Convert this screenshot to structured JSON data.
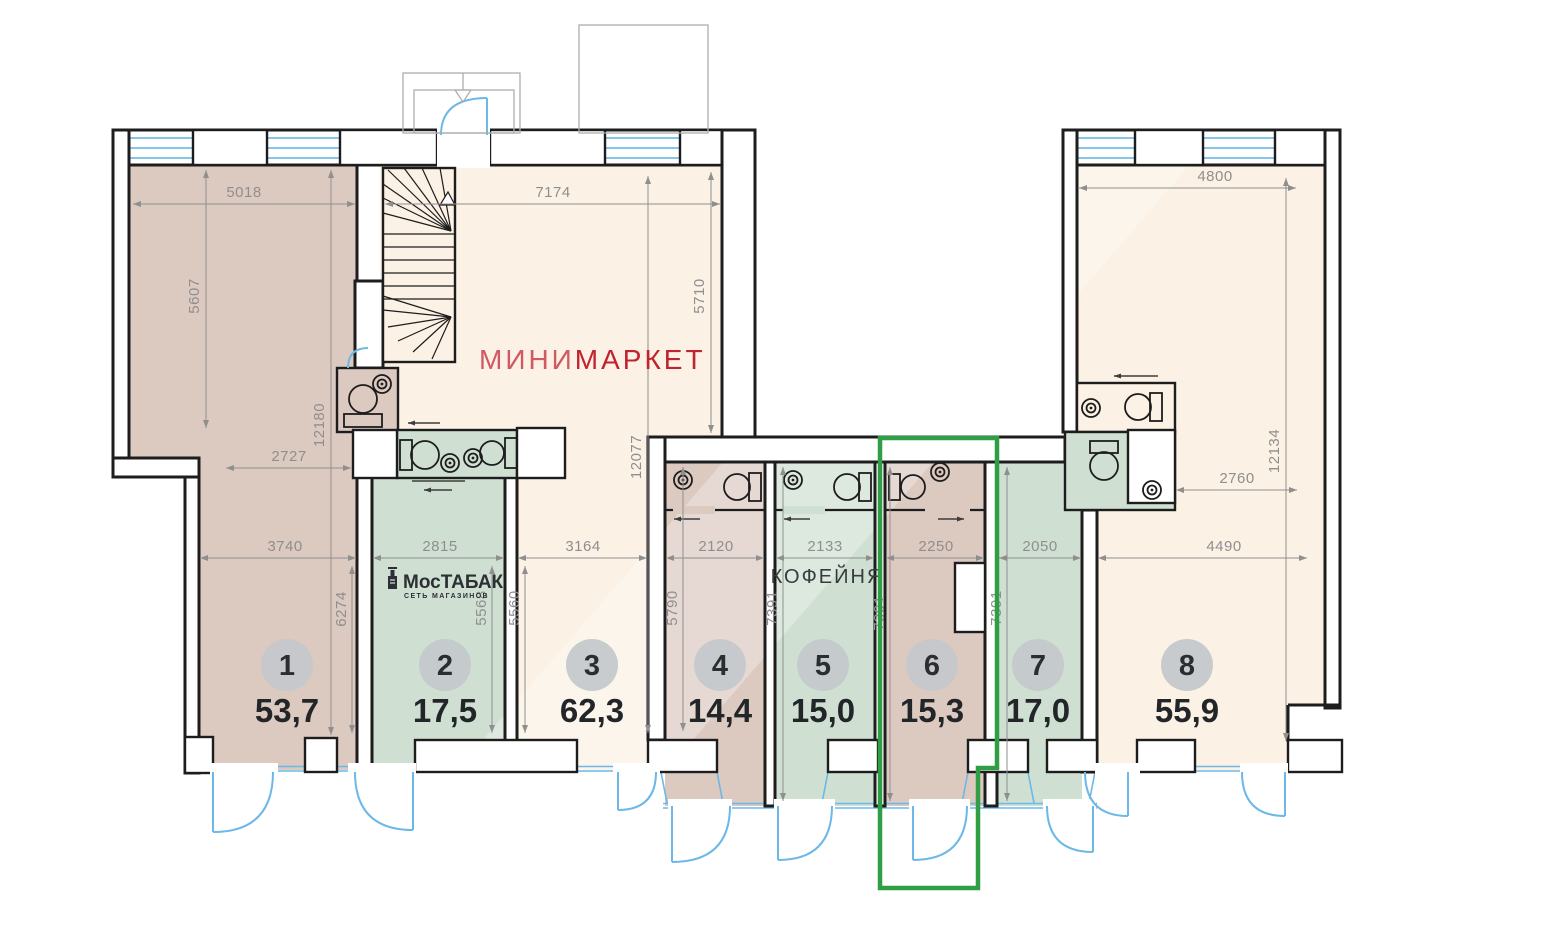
{
  "labels": {
    "minimarket_prefix": "МИНИ",
    "minimarket_suffix": "МАРКЕТ",
    "mostabak_name": "МосТАБАК",
    "mostabak_subtitle": "СЕТЬ МАГАЗИНОВ",
    "coffee": "КОФЕЙНЯ"
  },
  "units": [
    {
      "number": "1",
      "area": "53,7"
    },
    {
      "number": "2",
      "area": "17,5"
    },
    {
      "number": "3",
      "area": "62,3"
    },
    {
      "number": "4",
      "area": "14,4"
    },
    {
      "number": "5",
      "area": "15,0"
    },
    {
      "number": "6",
      "area": "15,3"
    },
    {
      "number": "7",
      "area": "17,0"
    },
    {
      "number": "8",
      "area": "55,9"
    }
  ],
  "dimensions": [
    {
      "value": "5018"
    },
    {
      "value": "7174"
    },
    {
      "value": "4800"
    },
    {
      "value": "5607"
    },
    {
      "value": "12180"
    },
    {
      "value": "5710"
    },
    {
      "value": "12077"
    },
    {
      "value": "12134"
    },
    {
      "value": "2727"
    },
    {
      "value": "2760"
    },
    {
      "value": "3740"
    },
    {
      "value": "2815"
    },
    {
      "value": "3164"
    },
    {
      "value": "2120"
    },
    {
      "value": "2133"
    },
    {
      "value": "2250"
    },
    {
      "value": "2050"
    },
    {
      "value": "4490"
    },
    {
      "value": "6274"
    },
    {
      "value": "5568"
    },
    {
      "value": "5560"
    },
    {
      "value": "5790"
    },
    {
      "value": "7391"
    },
    {
      "value": "7391"
    },
    {
      "value": "7391"
    }
  ],
  "colors": {
    "room_cream": "#fbf1e4",
    "room_taupe": "#dcc9c0",
    "room_green": "#cfe0d2",
    "wall": "#1d1d1d",
    "window_blue": "#5fb2e5",
    "door_blue": "#6cb8e8",
    "dimension_gray": "#8f8f8f",
    "highlight_green": "#2f9e44",
    "brand_red_light": "#d05963",
    "brand_red": "#c1232e",
    "badge_gray": "#c4c8cb"
  }
}
